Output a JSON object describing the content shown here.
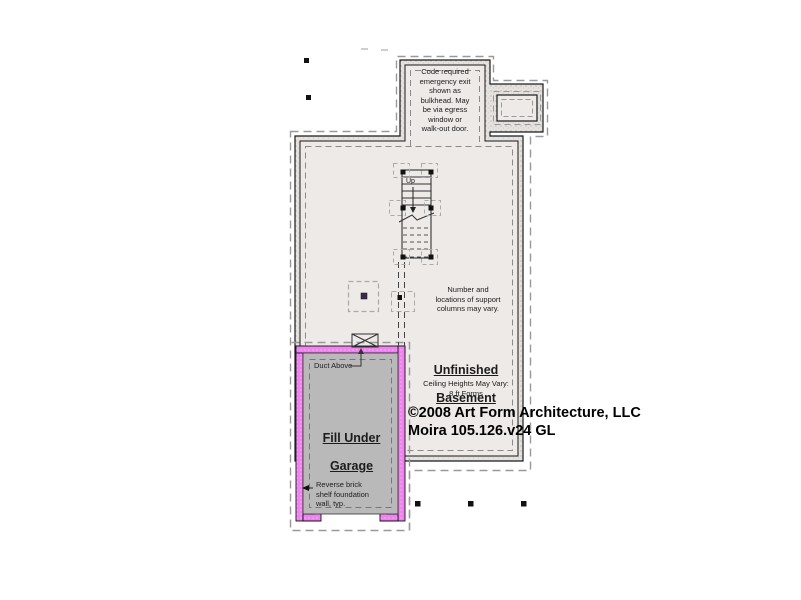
{
  "plan": {
    "labels": {
      "code_note": "Code required\nemergency exit\nshown as\nbulkhead. May\nbe via egress\nwindow or\nwalk-out door.",
      "columns_note": "Number and\nlocations of support\ncolumns may vary.",
      "room_title_line1": "Unfinished",
      "room_title_line2": "Basement",
      "ceiling_note": "Ceiling Heights May Vary:\n8 ft Forms",
      "copyright_line1": "©2008 Art Form Architecture, LLC",
      "copyright_line2": "Moira 105.126.v24 GL",
      "garage_title_line1": "Fill Under",
      "garage_title_line2": "Garage",
      "duct_label": "Duct Above",
      "wall_note": "Reverse brick\nshelf foundation\nwall, typ.",
      "stairs_up_label": "Up"
    },
    "colors": {
      "background": "#ffffff",
      "interior_fill": "#edeae8",
      "garage_fill": "#b9b9b9",
      "garage_wall": "#ee82ee",
      "wall_line": "#1a1a1a",
      "dashed_line": "#999999"
    }
  }
}
